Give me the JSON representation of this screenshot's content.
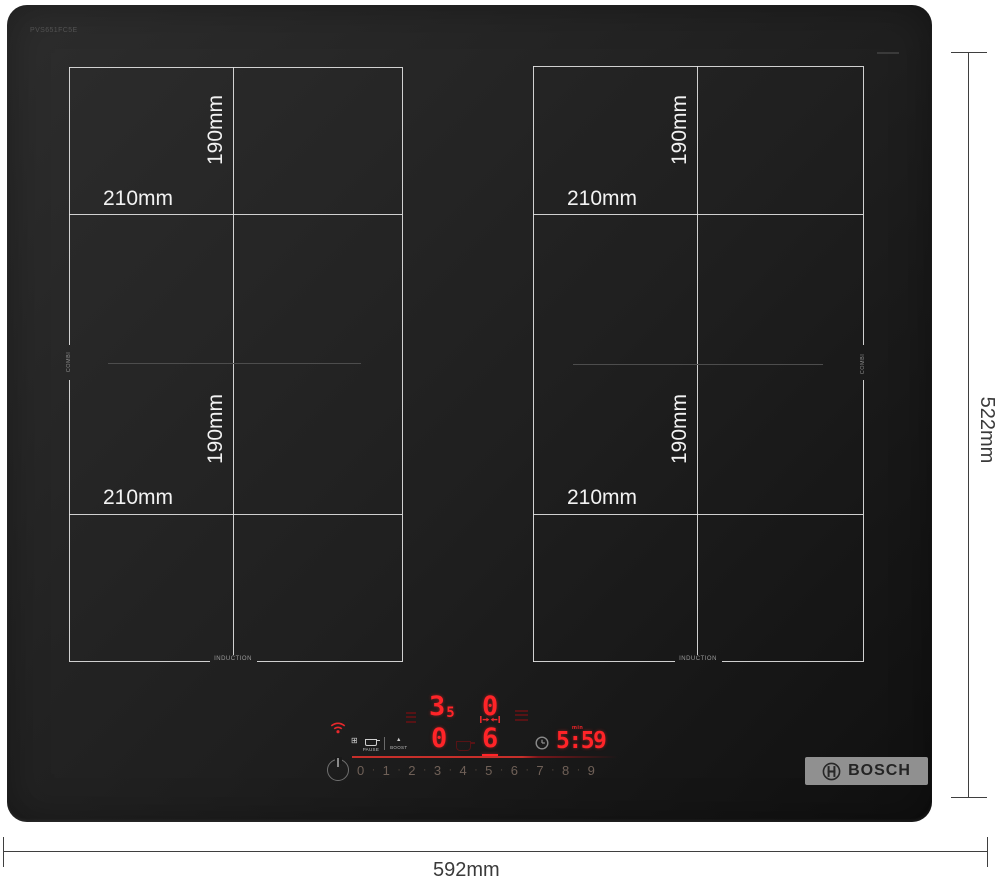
{
  "colors": {
    "led_red": "#ff2428",
    "led_dim_red": "#571315",
    "accent_line_red": "#c62f2a",
    "zone_line": "#dfdfdf",
    "dimension_text": "#3a3a3a",
    "logo_bar_bg": "#909090"
  },
  "glass": {
    "model_code": "PVS651FC5E",
    "combi_label": "COMBI",
    "induction_label": "INDUCTION"
  },
  "zones": {
    "rear_left": {
      "width": "210mm",
      "depth": "190mm"
    },
    "front_left": {
      "width": "210mm",
      "depth": "190mm"
    },
    "rear_right": {
      "width": "210mm",
      "depth": "190mm"
    },
    "front_right": {
      "width": "210mm",
      "depth": "190mm"
    }
  },
  "annotations": {
    "overall_width": "592mm",
    "overall_depth": "522mm"
  },
  "control_panel": {
    "icons": {
      "grid": "⊞",
      "boost": "▲"
    },
    "function_labels": {
      "pause": "PAUSE",
      "boost": "BOOST"
    },
    "displays": {
      "rear_left": {
        "main": "3",
        "half": "5"
      },
      "rear_right": {
        "main": "0"
      },
      "front_left": {
        "main": "0"
      },
      "front_right": {
        "main": "6"
      }
    },
    "timer": {
      "value": "5:59",
      "unit": "min"
    },
    "power_slider": {
      "numbers": [
        "0",
        "1",
        "2",
        "3",
        "4",
        "5",
        "6",
        "7",
        "8",
        "9"
      ],
      "separator": "·"
    }
  },
  "brand": {
    "name": "BOSCH"
  }
}
